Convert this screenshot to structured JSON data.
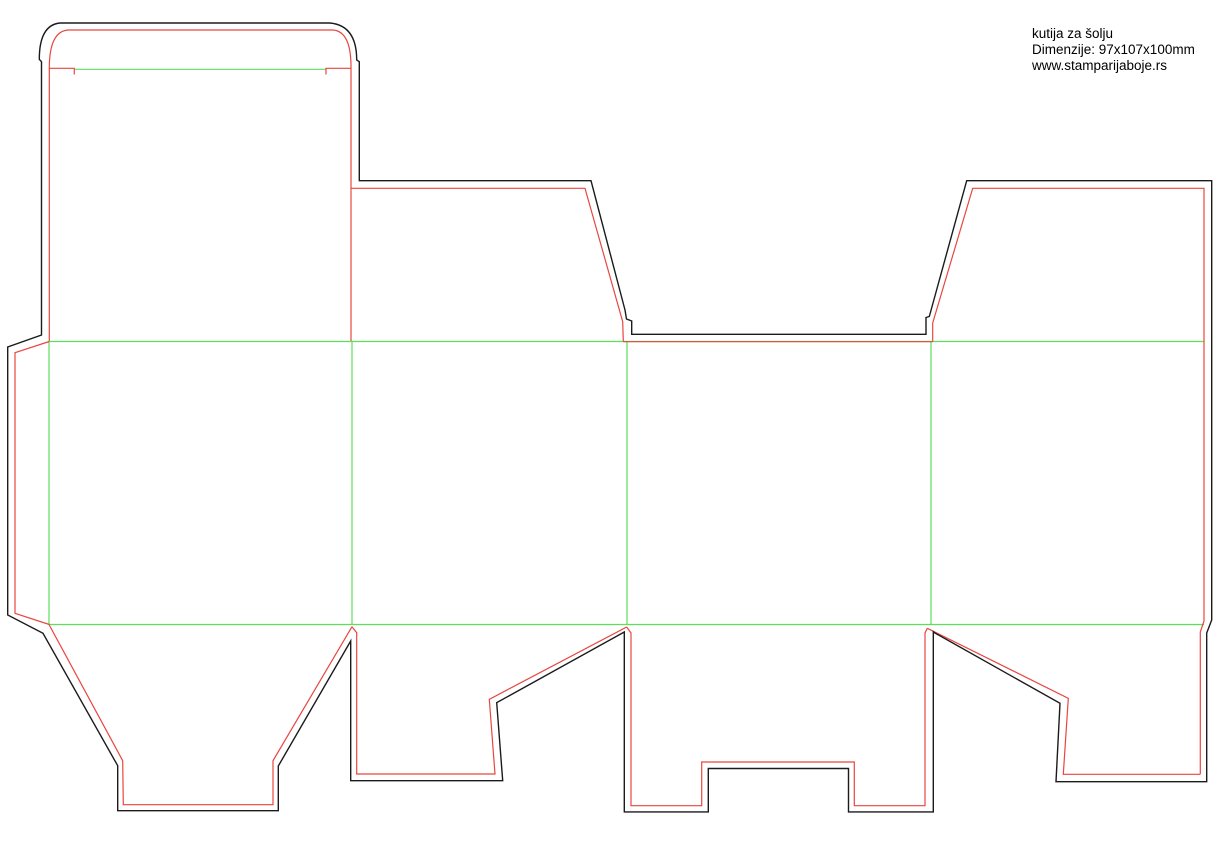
{
  "page": {
    "width": 1219,
    "height": 842,
    "background": "#ffffff"
  },
  "annotation": {
    "title": "kutija za šolju",
    "dimensions": "Dimenzije: 97x107x100mm",
    "website": "www.stamparijaboje.rs"
  },
  "colors": {
    "cut": "#1b1b1b",
    "bleed": "#e8463f",
    "fold": "#5ce05c"
  },
  "dieline": {
    "viewbox": "0 0 1219 842",
    "stroke_widths": {
      "cut": 1.4,
      "bleed": 1.2,
      "fold": 1.2
    },
    "paths": [
      {
        "name": "fold-tuck-flap",
        "layer": "fold",
        "d": "M75,69.3 H325.5"
      },
      {
        "name": "fold-top-body",
        "layer": "fold",
        "d": "M49,341.5 H1204"
      },
      {
        "name": "fold-bottom-body",
        "layer": "fold",
        "d": "M49,624.5 H1204"
      },
      {
        "name": "fold-glue-flap",
        "layer": "fold",
        "d": "M49,341.5 V624.5"
      },
      {
        "name": "fold-panel-1-2",
        "layer": "fold",
        "d": "M352,341.5 V624.5"
      },
      {
        "name": "fold-panel-2-3",
        "layer": "fold",
        "d": "M627,341.5 V624.5"
      },
      {
        "name": "fold-panel-3-4",
        "layer": "fold",
        "d": "M931,341.5 V624.5"
      },
      {
        "name": "bleed-lid-and-tuck",
        "layer": "bleed",
        "d": "M49.3,341 V68.3 Q49.3,31.5 68,30 H333 Q351,31.5 351,66.7 V341"
      },
      {
        "name": "bleed-tuck-shoulder-left",
        "layer": "bleed",
        "d": "M49.3,68.3 H74.3 V74.5"
      },
      {
        "name": "bleed-tuck-shoulder-right",
        "layer": "bleed",
        "d": "M351,68.3 H326 V74.5"
      },
      {
        "name": "bleed-glue-flap",
        "layer": "bleed",
        "d": "M49.3,341.5 L15,352.7 V613.3 L49.3,624.5"
      },
      {
        "name": "bleed-dust-flap-left",
        "layer": "bleed",
        "d": "M351,188.3 H585 L622.7,321.7 L623.3,341.5"
      },
      {
        "name": "bleed-gap-on-fold",
        "layer": "bleed",
        "d": "M623.3,341.7 H932.7"
      },
      {
        "name": "bleed-dust-flap-right",
        "layer": "bleed",
        "d": "M932.7,341.5 V323 L972.7,188.3 H1204 V621 L1200.3,632 V774.3"
      },
      {
        "name": "bleed-bottom-flap-4",
        "layer": "bleed",
        "d": "M1200.3,774.3 H1063.3 L1068.3,698.3 L927.3,628.3"
      },
      {
        "name": "bleed-bottom-flap-3",
        "layer": "bleed",
        "d": "M927.3,628.3 L925,633 V805.7 H854.3 V762 H701.7 V805.7 H631 V633 L626.7,627"
      },
      {
        "name": "bleed-bottom-flap-2",
        "layer": "bleed",
        "d": "M626.7,627 L489.3,699.3 L495,774 H356.7 V632.7 L352,626.7"
      },
      {
        "name": "bleed-bottom-flap-1",
        "layer": "bleed",
        "d": "M352,626.7 L273,760.7 V804.7 H123.3 L122.7,760.7 L49,624.5"
      },
      {
        "name": "cut-outline",
        "layer": "cut",
        "d": "M41.5,61.7 L39.3,59.3 Q39.3,25 60,23 H330 Q356.7,25.5 356.7,60 L359.3,61.7 V180.7 H591 L625,310 L626.5,319 L631.7,321 V334.3 H926 V317.5 L929.3,316.5 L966.7,180.7 H1211.7 V620 L1206.7,633 V781.7 H1056 L1060,703.3 L935,633 L933.3,631.7 V811.9 H848.5 V768.5 H708.3 V811.9 H624.3 V632 L496.7,702.7 L502.7,780.7 H350.7 V641 L278.3,766 V810.7 H117.7 V765.7 L43,633.3 L7.7,615 V347 L41.5,335 Z"
      }
    ]
  }
}
